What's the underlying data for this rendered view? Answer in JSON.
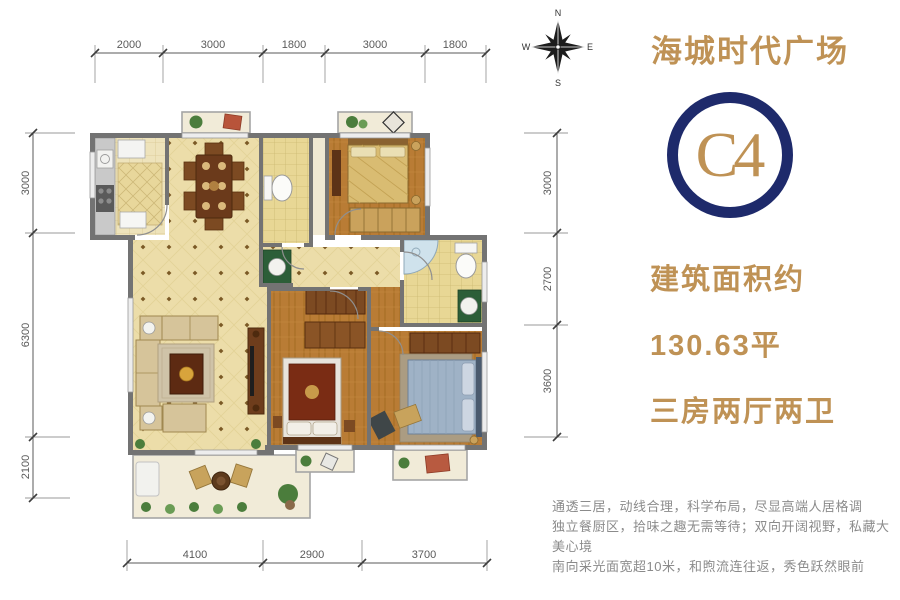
{
  "header": {
    "project_title": "海城时代广场",
    "unit_code": "C4"
  },
  "info": {
    "area_label": "建筑面积约",
    "area_value": "130.63平",
    "layout_type": "三房两厅两卫"
  },
  "description": {
    "line1": "通透三居，动线合理，科学布局，尽显高端人居格调",
    "line2": "独立餐厨区，拾味之趣无需等待；双向开阔视野，私藏大美心境",
    "line3": "南向采光面宽超10米，和煦流连往返，秀色跃然眼前"
  },
  "compass": {
    "north": "N",
    "east": "E",
    "south": "S",
    "west": "W"
  },
  "dimensions": {
    "top": [
      "2000",
      "3000",
      "1800",
      "3000",
      "1800"
    ],
    "left": [
      "3000",
      "6300",
      "2100"
    ],
    "right": [
      "3000",
      "2700",
      "3600"
    ],
    "bottom": [
      "4100",
      "2900",
      "3700"
    ]
  },
  "colors": {
    "accent_gold": "#bf9255",
    "badge_navy": "#1e2a6b",
    "description_gray": "#8b8b8b",
    "wall_gray": "#737373",
    "dimension_gray": "#5a5a5a"
  }
}
